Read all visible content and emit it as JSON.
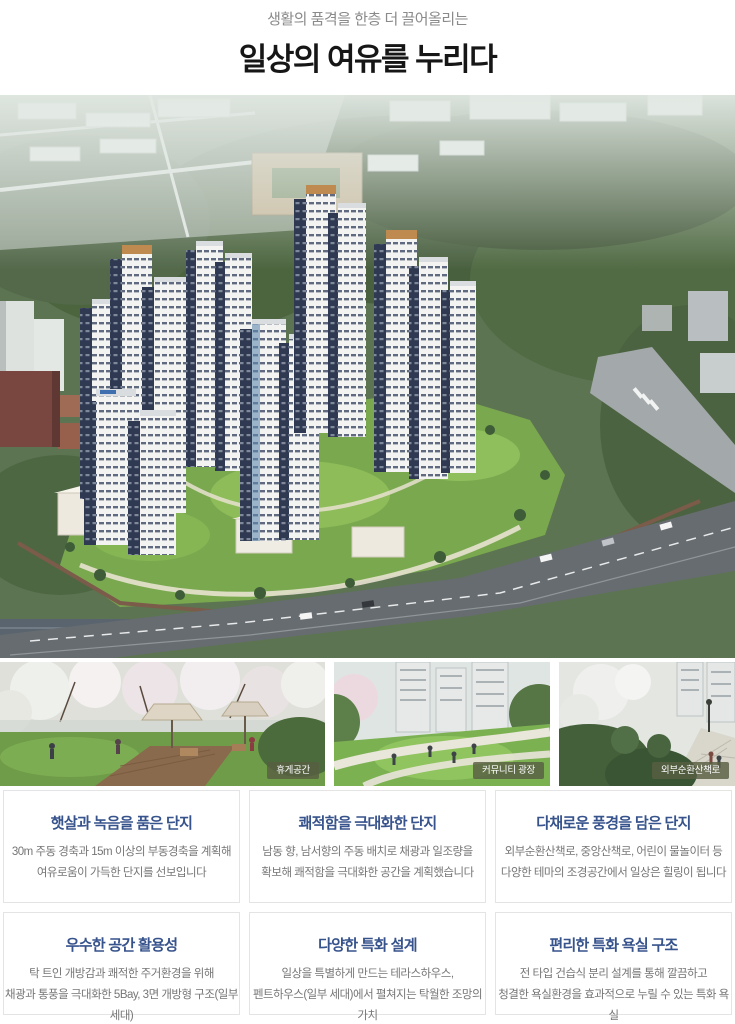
{
  "header": {
    "subtitle": "생활의 품격을 한층 더 끌어올리는",
    "title": "일상의 여유를 누리다"
  },
  "hero": {
    "description": "아파트 단지 조감도"
  },
  "photos": [
    {
      "caption": "휴게공간"
    },
    {
      "caption": "커뮤니티 광장"
    },
    {
      "caption": "외부순환산책로"
    }
  ],
  "cards": [
    {
      "title": "햇살과 녹음을 품은 단지",
      "line1": "30m 주동 경축과 15m 이상의 부동경축을 계획해",
      "line2": "여유로움이 가득한 단지를 선보입니다"
    },
    {
      "title": "쾌적함을 극대화한 단지",
      "line1": "남동 향, 남서향의 주동 배치로 채광과 일조량을",
      "line2": "확보해 쾌적함을 극대화한 공간을 계획했습니다"
    },
    {
      "title": "다채로운 풍경을 담은 단지",
      "line1": "외부순환산책로, 중앙산책로, 어린이 물놀이터 등",
      "line2": "다양한 테마의 조경공간에서 일상은 힐링이 됩니다"
    },
    {
      "title": "우수한 공간 활용성",
      "line1": "탁 트인 개방감과 쾌적한 주거환경을 위해",
      "line2": "채광과 통풍을 극대화한 5Bay, 3면 개방형 구조(일부 세대)"
    },
    {
      "title": "다양한 특화 설계",
      "line1": "일상을 특별하게 만드는 테라스하우스,",
      "line2": "펜트하우스(일부 세대)에서 펼쳐지는 탁월한 조망의 가치"
    },
    {
      "title": "편리한 특화 욕실 구조",
      "line1": "전 타입 건습식 분리 설계를 통해 깔끔하고",
      "line2": "청결한 욕실환경을 효과적으로 누릴 수 있는 특화 욕실"
    }
  ],
  "colors": {
    "card_title_navy": "#37538c",
    "body_text_gray": "#767676",
    "caption_chip": "rgba(88,94,66,0.82)"
  }
}
